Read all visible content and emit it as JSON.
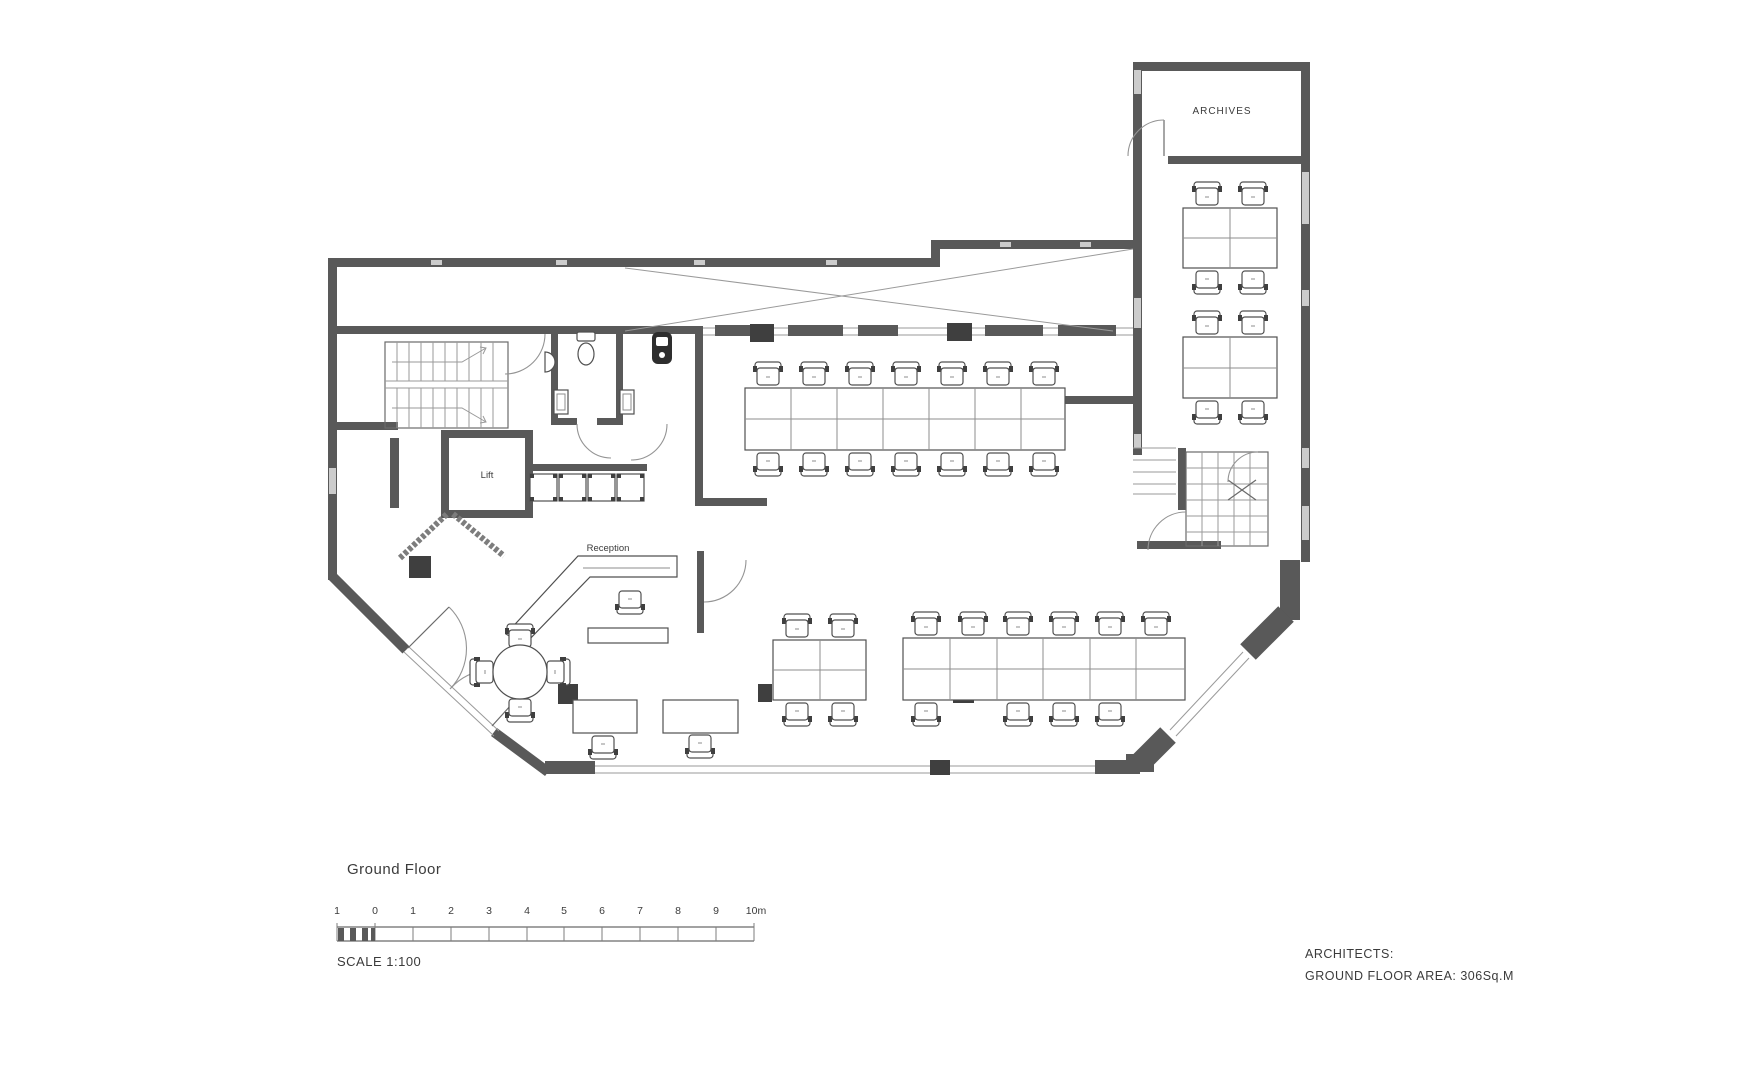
{
  "drawing": {
    "labels": {
      "archives": "ARCHIVES",
      "lift": "Lift",
      "reception": "Reception"
    },
    "colors": {
      "wall": "#595959",
      "window_line": "#9a9a9a",
      "furniture_line": "#505050",
      "text": "#3b3b3b",
      "background": "#ffffff"
    }
  },
  "title": {
    "text": "Ground Floor"
  },
  "scale_bar": {
    "label": "SCALE 1:100",
    "ticks": [
      "1",
      "0",
      "1",
      "2",
      "3",
      "4",
      "5",
      "6",
      "7",
      "8",
      "9",
      "10m"
    ]
  },
  "footer": {
    "architects_label": "ARCHITECTS:",
    "area_label": "GROUND FLOOR AREA: 306Sq.M"
  }
}
